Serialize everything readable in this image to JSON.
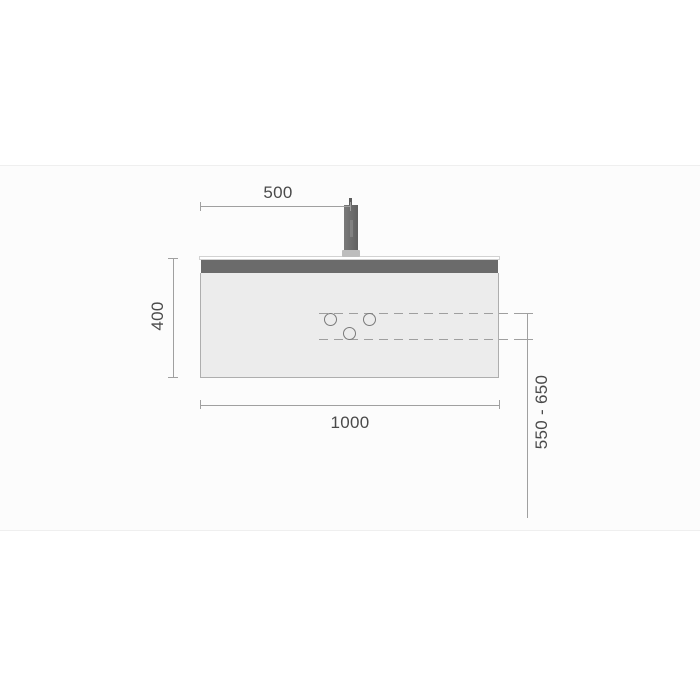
{
  "drawing": {
    "type": "technical-dimension-drawing",
    "subject": "wall-hung vanity unit with mixer tap, front elevation",
    "dimensions": {
      "top": "500",
      "left": "400",
      "bottom": "1000",
      "right": "550 - 650"
    },
    "drain_holes_count": 3,
    "palette": {
      "dimension_line": "#a0a0a0",
      "dimension_text": "#4a4a4a",
      "dashed_line": "#9f9f9f",
      "cabinet_fill": "#ececec",
      "cabinet_border": "#aeaeae",
      "top_rail": "#6b6b6b",
      "countertop": "#ffffff",
      "tap": "#6f6f6f",
      "tap_base": "#bdbdbd",
      "hole_stroke": "#7a7a7a",
      "stage_background": "#fcfcfc",
      "stage_border": "#efefef"
    }
  }
}
